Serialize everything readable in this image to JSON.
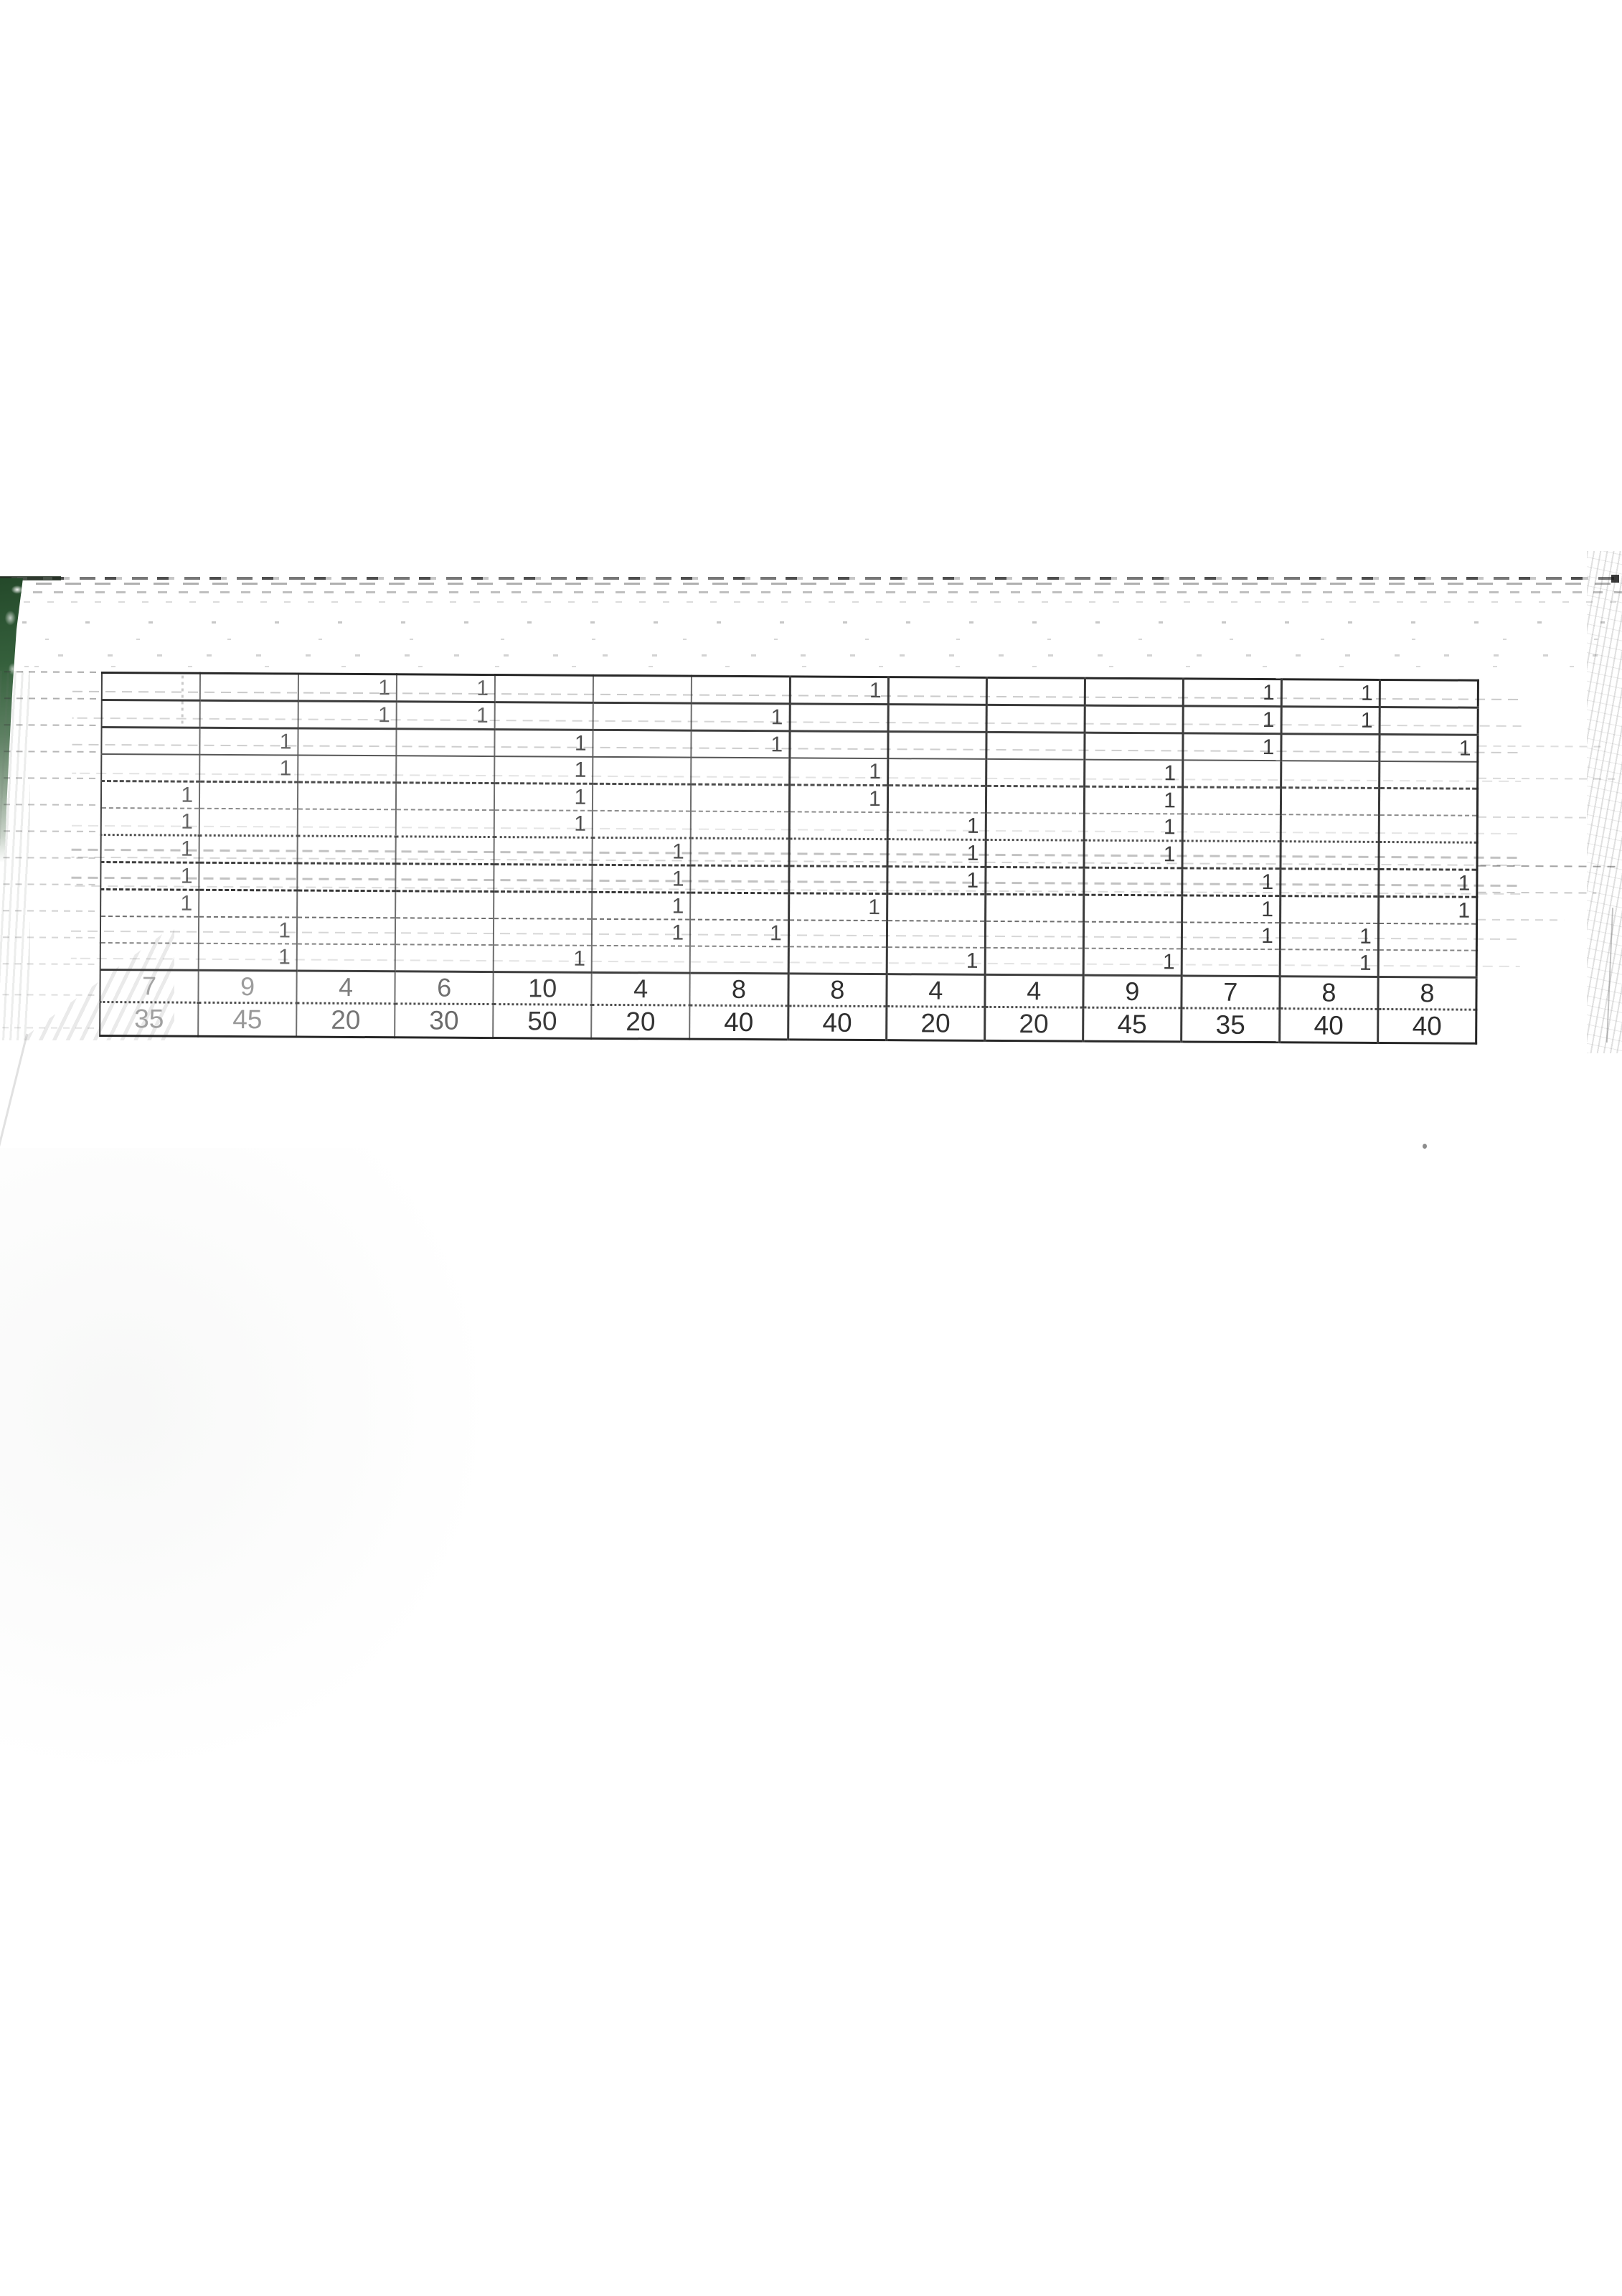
{
  "table": {
    "num_columns": 14,
    "mark": "1",
    "rows": [
      [
        "",
        "",
        "1",
        "1",
        "",
        "",
        "",
        "1",
        "",
        "",
        "",
        "1",
        "1",
        ""
      ],
      [
        "",
        "",
        "1",
        "1",
        "",
        "",
        "1",
        "",
        "",
        "",
        "",
        "1",
        "1",
        ""
      ],
      [
        "",
        "1",
        "",
        "",
        "1",
        "",
        "1",
        "",
        "",
        "",
        "",
        "1",
        "",
        "1"
      ],
      [
        "",
        "1",
        "",
        "",
        "1",
        "",
        "",
        "1",
        "",
        "",
        "1",
        "",
        "",
        ""
      ],
      [
        "1",
        "",
        "",
        "",
        "1",
        "",
        "",
        "1",
        "",
        "",
        "1",
        "",
        "",
        ""
      ],
      [
        "1",
        "",
        "",
        "",
        "1",
        "",
        "",
        "",
        "1",
        "",
        "1",
        "",
        "",
        ""
      ],
      [
        "1",
        "",
        "",
        "",
        "",
        "1",
        "",
        "",
        "1",
        "",
        "1",
        "",
        "",
        ""
      ],
      [
        "1",
        "",
        "",
        "",
        "",
        "1",
        "",
        "",
        "1",
        "",
        "",
        "1",
        "",
        "1"
      ],
      [
        "1",
        "",
        "",
        "",
        "",
        "1",
        "",
        "1",
        "",
        "",
        "",
        "1",
        "",
        "1"
      ],
      [
        "",
        "1",
        "",
        "",
        "",
        "1",
        "1",
        "",
        "",
        "",
        "",
        "1",
        "1",
        ""
      ],
      [
        "",
        "1",
        "",
        "",
        "1",
        "",
        "",
        "",
        "1",
        "",
        "1",
        "",
        "1",
        ""
      ]
    ],
    "count_row": [
      "7",
      "9",
      "4",
      "6",
      "10",
      "4",
      "8",
      "8",
      "4",
      "4",
      "9",
      "7",
      "8",
      "8"
    ],
    "points_row": [
      "35",
      "45",
      "20",
      "30",
      "50",
      "20",
      "40",
      "40",
      "20",
      "20",
      "45",
      "35",
      "40",
      "40"
    ]
  },
  "colors": {
    "paper": "#ffffff",
    "grid_dark": "#272727",
    "grid_faded": "#8c8c8c",
    "mark_ink": "#4a4a4a",
    "folder_green": "#2e5a33",
    "count_ink": [
      "#a4a4a4",
      "#9c9c9c",
      "#7e7e7e",
      "#707070",
      "#3e3e3e",
      "#3a3a3a",
      "#303030",
      "#303030",
      "#343434",
      "#343434",
      "#2f2f2f",
      "#303030",
      "#2e2e2e",
      "#2e2e2e"
    ],
    "points_ink": [
      "#a0a0a0",
      "#989898",
      "#767676",
      "#6a6a6a",
      "#3b3b3b",
      "#343434",
      "#2d2d2d",
      "#2f2f2f",
      "#323232",
      "#343434",
      "#2e2e2e",
      "#2f2f2f",
      "#2c2c2c",
      "#2c2c2c"
    ]
  }
}
